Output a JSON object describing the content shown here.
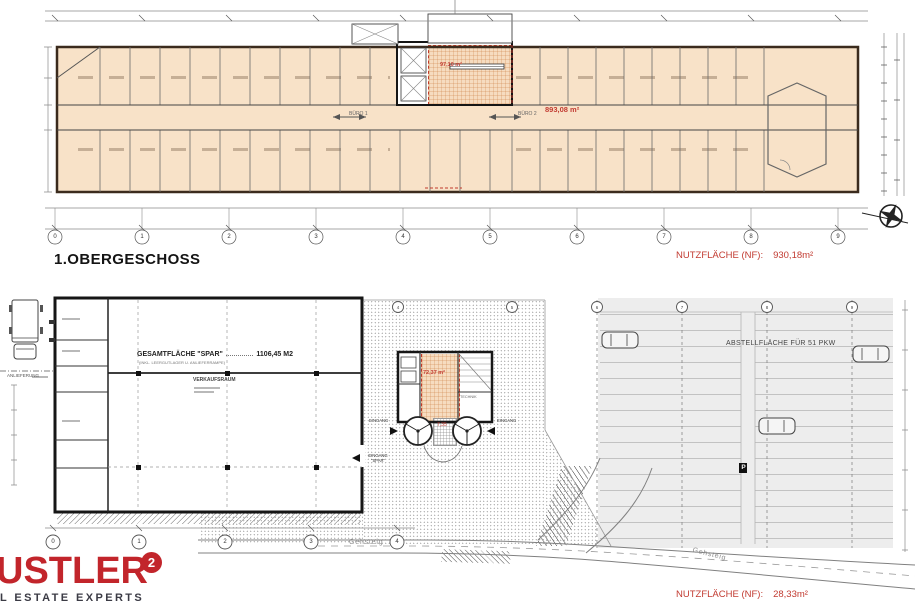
{
  "upper_plan": {
    "title": "1.OBERGESCHOSS",
    "nf_label": "NUTZFLÄCHE (NF):",
    "nf_value": "930,18m²",
    "buero1": "BÜRO 1",
    "buero2": "BÜRO 2",
    "buero2_area": "893,08 m²",
    "core_area": "97,10 m²",
    "grid": [
      "0",
      "1",
      "2",
      "3",
      "4",
      "5",
      "6",
      "7",
      "8",
      "9"
    ]
  },
  "ground_plan": {
    "nf_label": "NUTZFLÄCHE (NF):",
    "nf_value": "28,33m²",
    "spar_label": "GESAMTFLÄCHE \"SPAR\"",
    "spar_value": "1106,45 M2",
    "spar_note": "(INKL. LEERGUTLAGER U. ANLIEFERRAMPE)",
    "verkaufsraum": "VERKAUFSRAUM",
    "anlieferung": "ANLIEFERUNG",
    "parking_label": "ABSTELLFLÄCHE FÜR 51 PKW",
    "technik": "TECHNIK",
    "core_area": "72,37 m²",
    "mat_area": "7,35",
    "eingang_left": "EINGANG",
    "eingang_right": "EINGANG",
    "eingang_spar": "EINGANG \"SPAR\"",
    "gehsteig": "Gehsteig",
    "p_marker": "P",
    "grid_bottom": [
      "0",
      "1",
      "2",
      "3",
      "4"
    ],
    "grid_top": [
      "4",
      "5",
      "6",
      "7",
      "8",
      "9"
    ]
  },
  "logo": {
    "brand": "USTLER",
    "superscript": "2",
    "tagline": "L ESTATE EXPERTS",
    "accent_color": "#c2252b"
  },
  "colors": {
    "room_fill": "#f8e2c8",
    "plan_red": "#c23b31",
    "wall_dark": "#3b2b1d"
  }
}
